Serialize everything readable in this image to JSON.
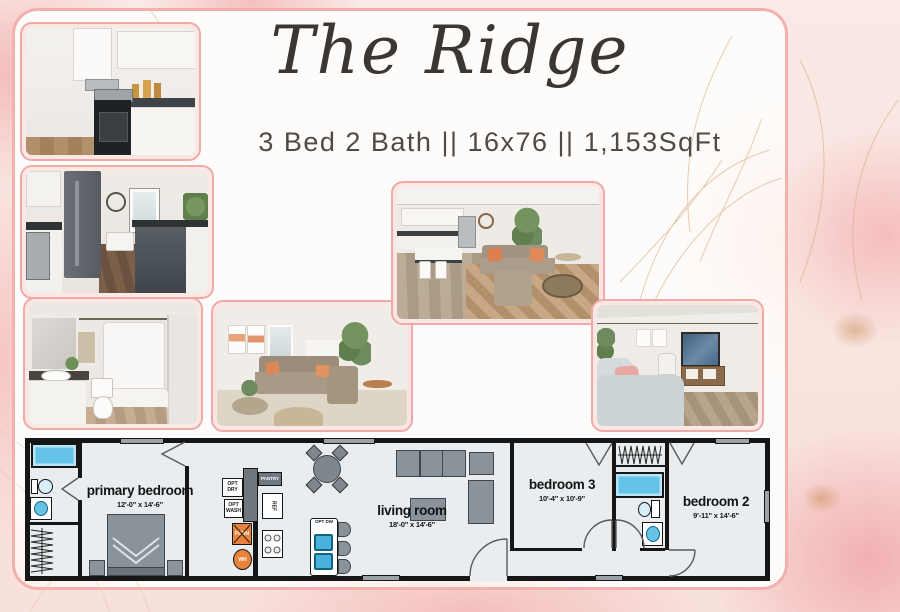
{
  "header": {
    "title": "The Ridge",
    "subtitle": "3 Bed 2 Bath || 16x76 || 1,153SqFt"
  },
  "photos": {
    "kitchen_closeup": "kitchen with stainless range and white cabinets",
    "kitchen_dining": "kitchen with refrigerator, dishwasher and dining nook",
    "bathroom": "bathroom with vanity, toilet and tub shower",
    "living_room": "living room with sectional sofa and plants",
    "open_concept": "open concept living room with kitchen island",
    "bedroom": "bedroom with upholstered bed and media console"
  },
  "floorplan": {
    "rooms": {
      "primary_bedroom": {
        "label": "primary bedroom",
        "dims": "12'-0\" x 14'-6\""
      },
      "living_room": {
        "label": "living room",
        "dims": "18'-0\" x 14'-6\""
      },
      "bedroom_3": {
        "label": "bedroom 3",
        "dims": "10'-4\" x 10'-9\""
      },
      "bedroom_2": {
        "label": "bedroom 2",
        "dims": "9'-11\" x 14'-6\""
      }
    },
    "labels": {
      "opt_dry": "OPT DRY",
      "opt_wash": "OPT WASH",
      "pantry": "PANTRY",
      "ref": "REF",
      "furn": "FURN",
      "water_heater": "WH",
      "opt_dw": "OPT DW"
    },
    "colors": {
      "wall": "#161616",
      "floor": "#e9edef",
      "furniture_gray": "#8a9399",
      "fixture_blue": "#64c3e7",
      "utility_orange": "#e8823d"
    }
  },
  "theme": {
    "marble_pink": "#f6cfcd",
    "panel_border": "#f3b1ae",
    "photo_frame": "#fbe7e3",
    "gold_accent": "#c89a5f",
    "text_dark": "#3a3633"
  }
}
